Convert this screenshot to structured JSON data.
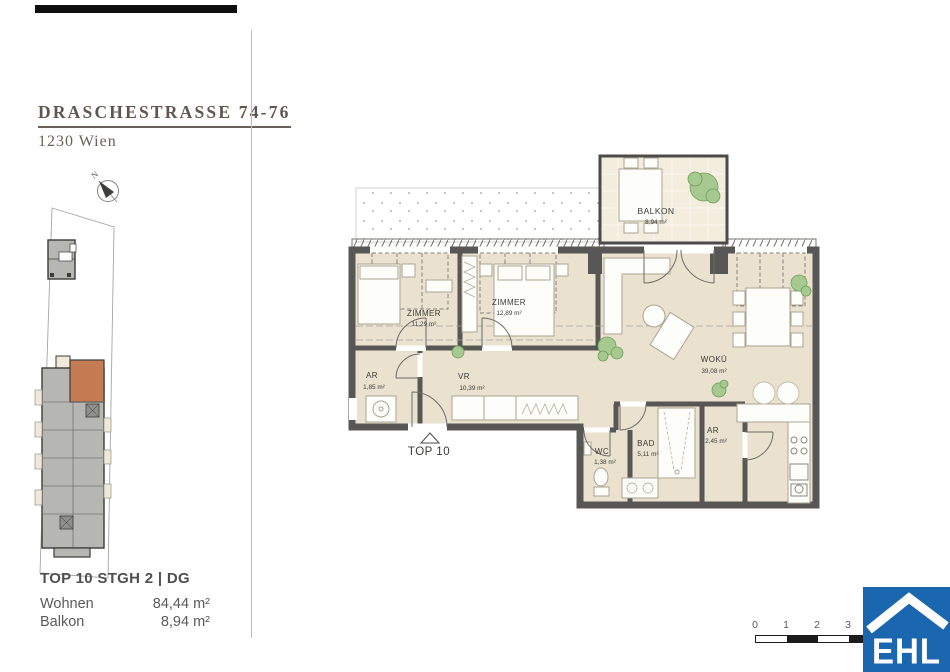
{
  "header": {
    "title": "DRASCHESTRASSE 74-76",
    "subtitle": "1230 Wien"
  },
  "compass": {
    "label": "N"
  },
  "site_plan": {
    "highlight_color": "#c67c52",
    "building_color": "#b6b6b2"
  },
  "floor_plan": {
    "wall_color": "#585755",
    "floor_color": "#eae2cf",
    "entrance_label": "TOP 10",
    "rooms": [
      {
        "name": "BALKON",
        "area": "8,94 m²"
      },
      {
        "name": "ZIMMER",
        "area": "11,29 m²"
      },
      {
        "name": "ZIMMER",
        "area": "12,89 m²"
      },
      {
        "name": "AR",
        "area": "1,85 m²"
      },
      {
        "name": "VR",
        "area": "10,39 m²"
      },
      {
        "name": "WOKÜ",
        "area": "39,08 m²"
      },
      {
        "name": "WC",
        "area": "1,38 m²"
      },
      {
        "name": "BAD",
        "area": "5,11 m²"
      },
      {
        "name": "AR",
        "area": "2,45 m²"
      }
    ]
  },
  "unit_info": {
    "title": "TOP 10 STGH 2 | DG",
    "rows": [
      {
        "label": "Wohnen",
        "value": "84,44 m²"
      },
      {
        "label": "Balkon",
        "value": "8,94 m²"
      }
    ]
  },
  "scale_bar": {
    "ticks": [
      "0",
      "1",
      "2",
      "3"
    ]
  },
  "logo": {
    "text": "EHL",
    "color": "#1a67b0"
  }
}
